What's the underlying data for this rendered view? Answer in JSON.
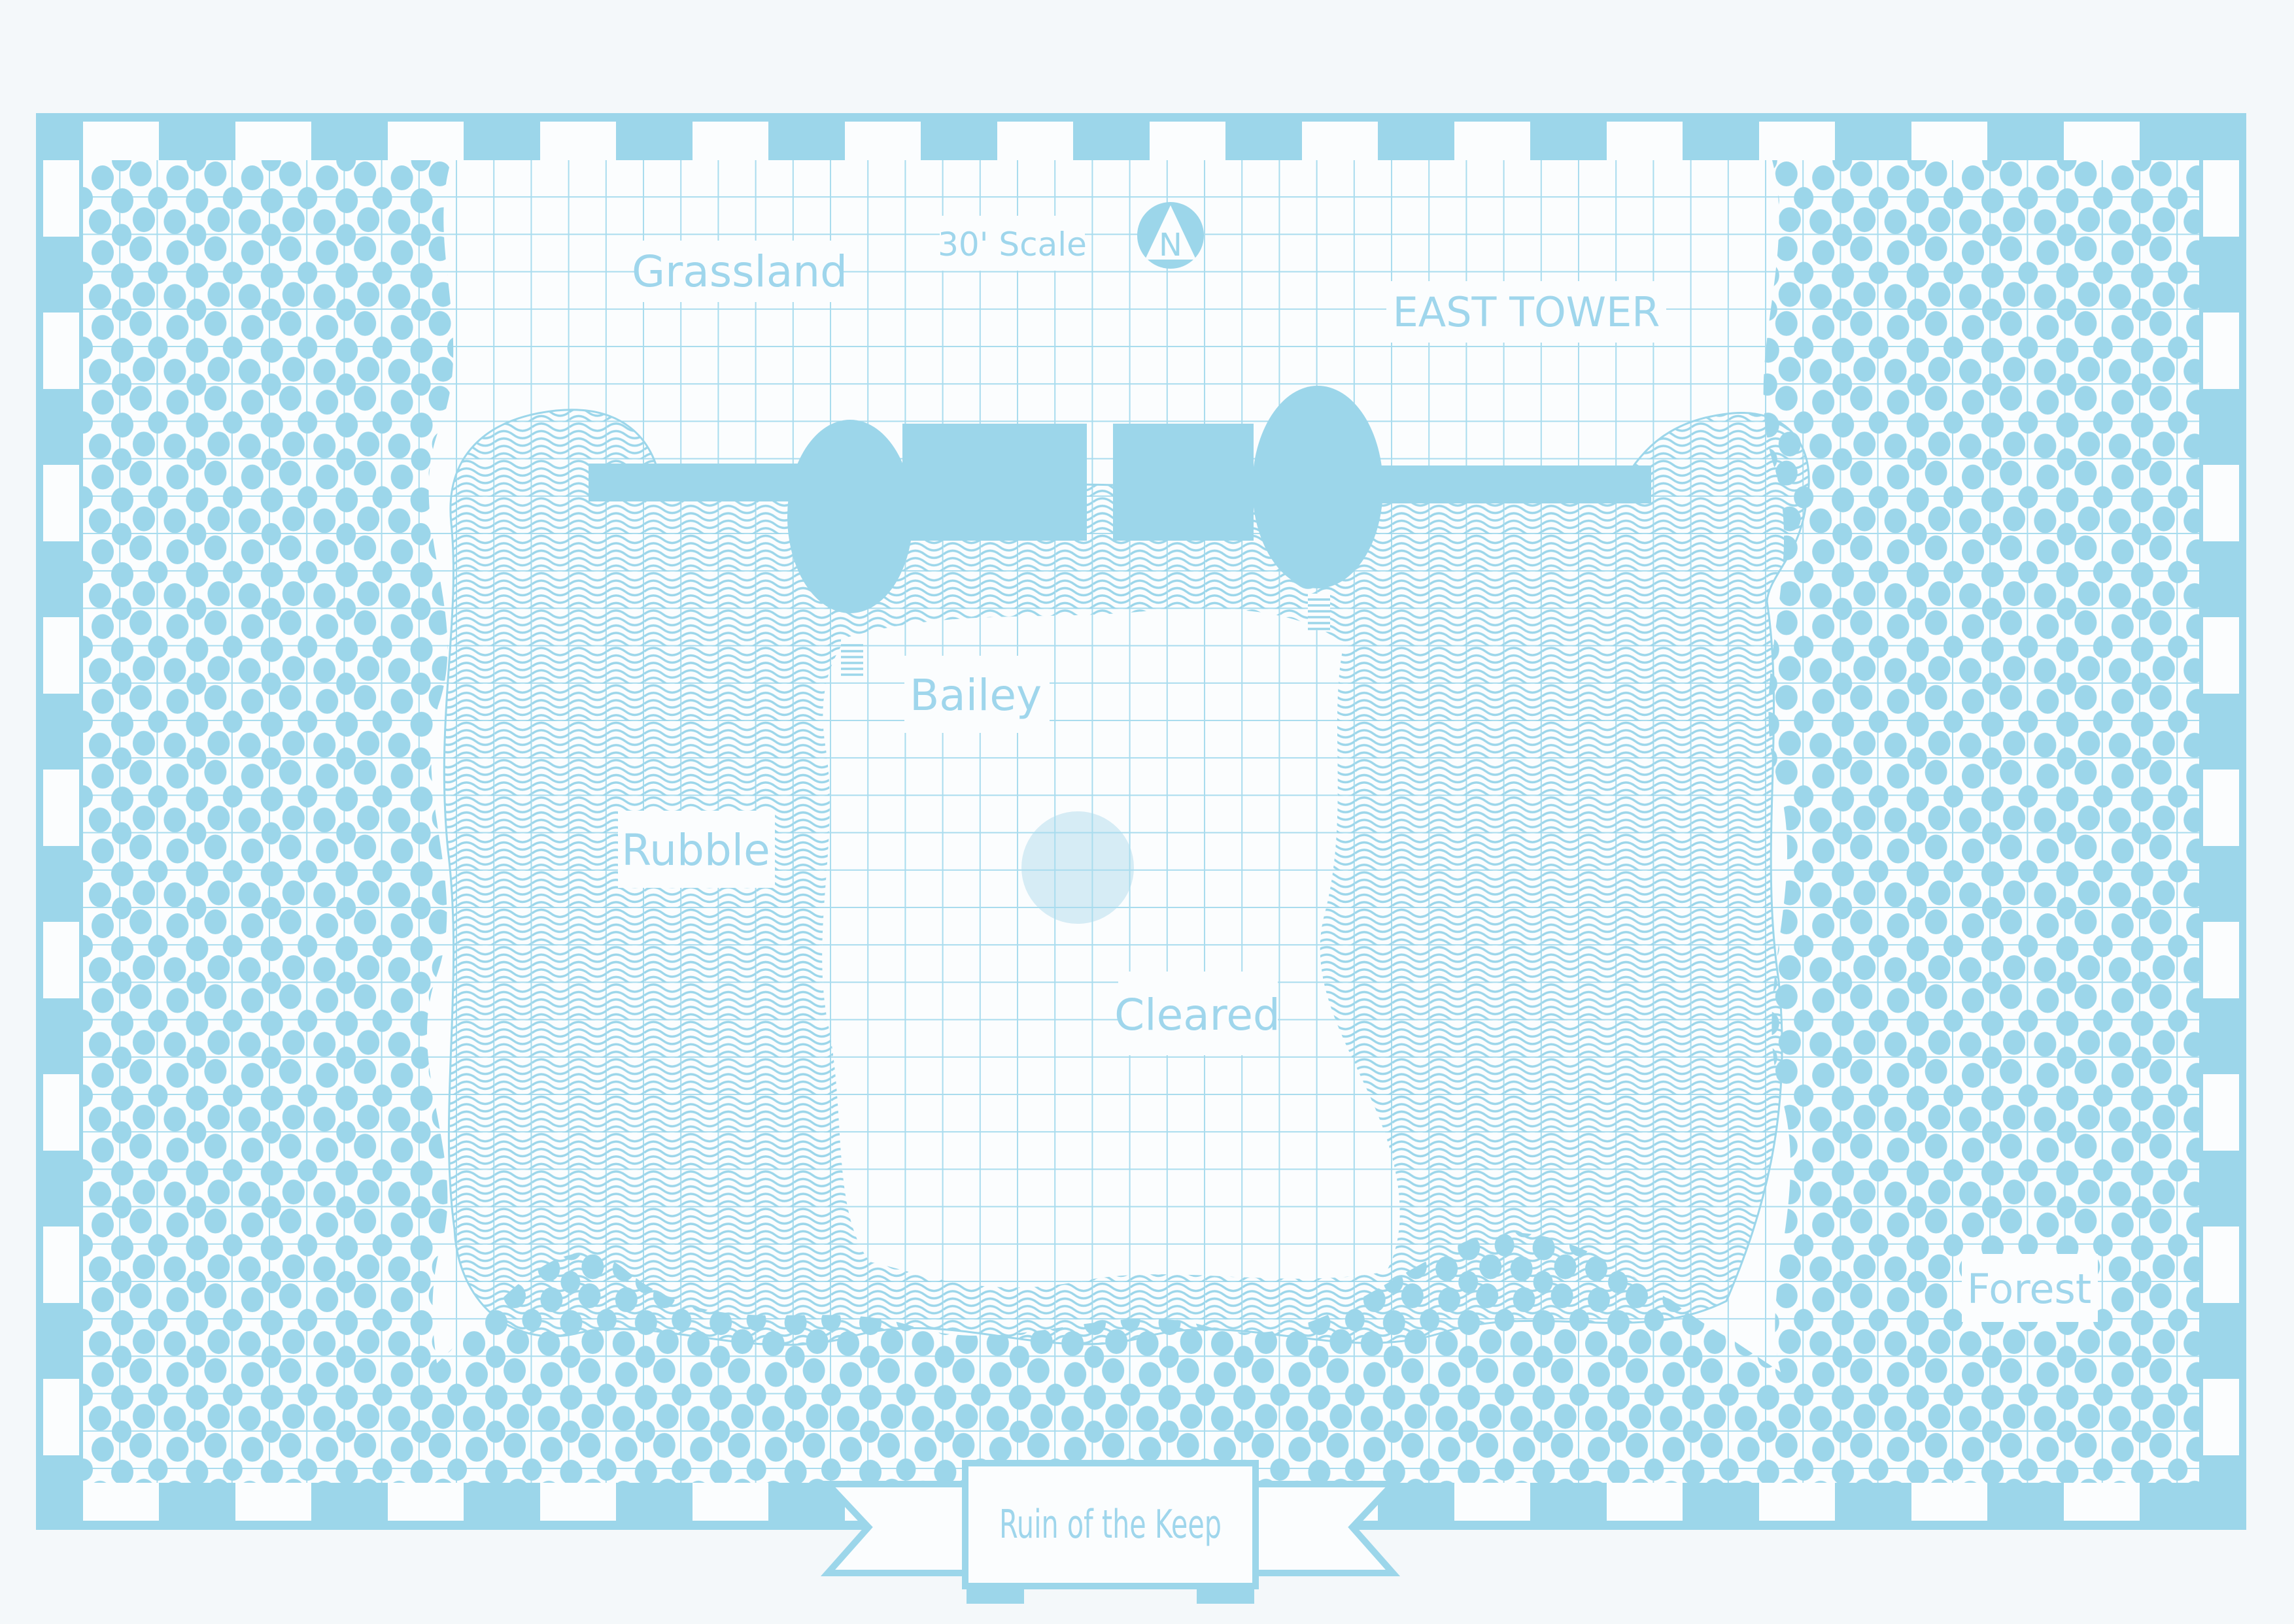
{
  "title_banner": {
    "text": "Ruin of the Keep"
  },
  "compass": {
    "letter": "N"
  },
  "scale_label": {
    "text": "30' Scale"
  },
  "region_labels": {
    "grassland": "Grassland",
    "east_tower": "EAST TOWER",
    "bailey": "Bailey",
    "rubble": "Rubble",
    "cleared": "Cleared",
    "forest": "Forest"
  },
  "colors": {
    "primary_blue": "#9cd6ea",
    "grid_blue": "#a9dcee",
    "well_light_blue": "#d6ecf5",
    "map_white": "#fbfdfe",
    "page_background": "#f4f8fa",
    "label_text": "#9fd6ec"
  }
}
